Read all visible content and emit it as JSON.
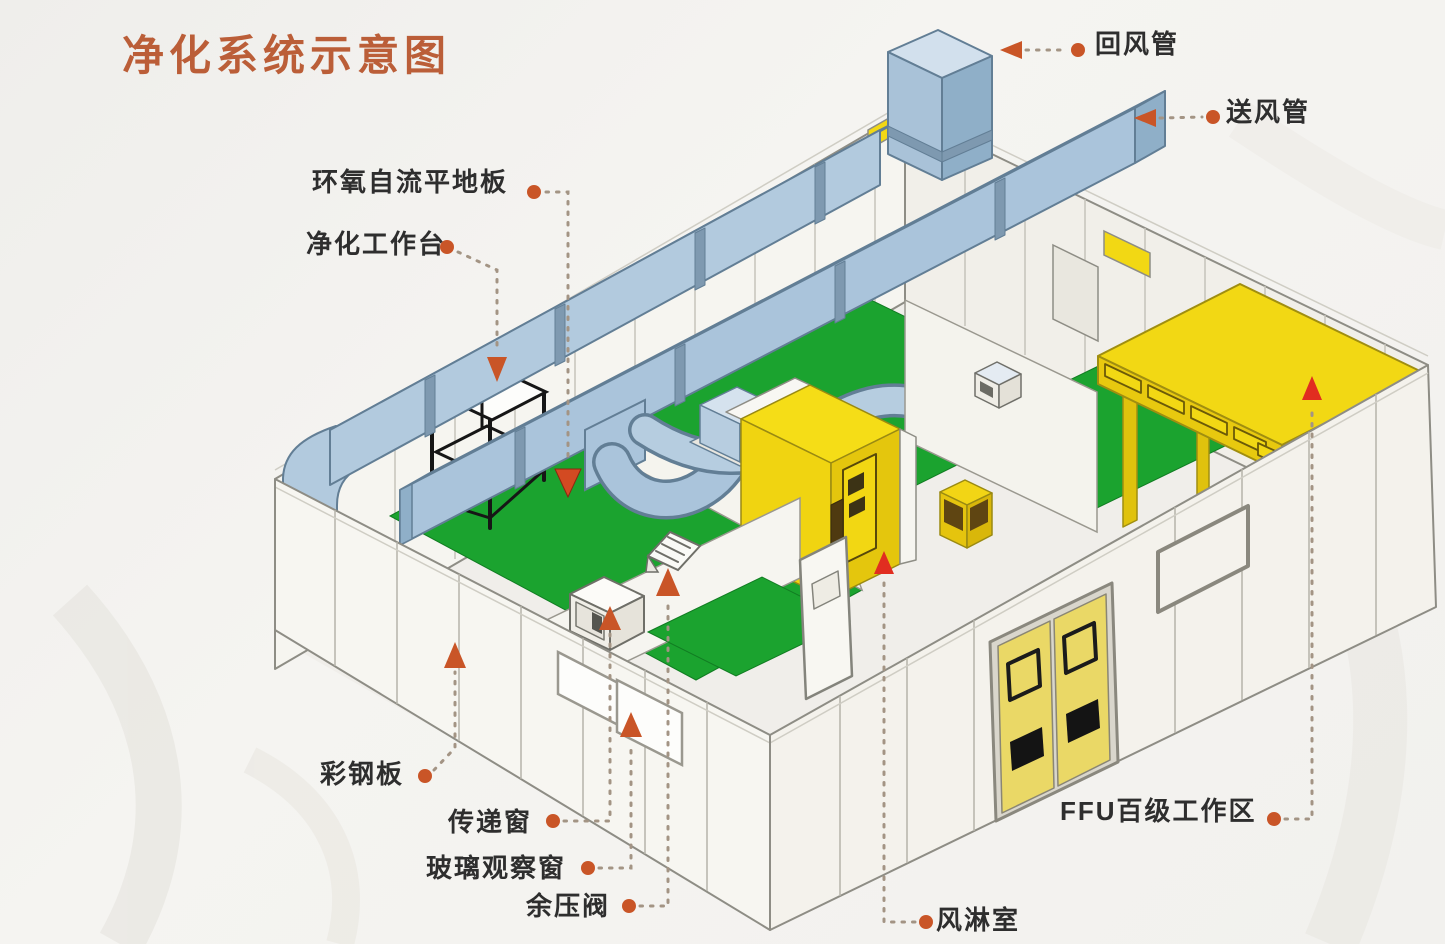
{
  "title": {
    "text": "净化系统示意图",
    "color": "#bb5e38"
  },
  "labels": [
    {
      "id": "return-air-duct",
      "text": "回风管"
    },
    {
      "id": "supply-air-duct",
      "text": "送风管"
    },
    {
      "id": "epoxy-self-leveling-floor",
      "text": "环氧自流平地板"
    },
    {
      "id": "clean-workbench",
      "text": "净化工作台"
    },
    {
      "id": "color-steel-panel",
      "text": "彩钢板"
    },
    {
      "id": "transfer-window",
      "text": "传递窗"
    },
    {
      "id": "glass-observation-window",
      "text": "玻璃观察窗"
    },
    {
      "id": "residual-pressure-valve",
      "text": "余压阀"
    },
    {
      "id": "air-shower-room",
      "text": "风淋室"
    },
    {
      "id": "ffu-class100-work-area",
      "text": "FFU百级工作区"
    }
  ],
  "colors": {
    "accent_orange": "#c95527",
    "accent_red": "#e12d20",
    "title_orange": "#bb5e38",
    "duct_blue": "#adc6dd",
    "floor_green": "#1ba32f",
    "equipment_yellow": "#f2d814",
    "door_yellow": "#ead866",
    "wall_white": "#f7f6f1",
    "outline_gray": "#8e8d85",
    "label_text": "#2e2e2e"
  }
}
